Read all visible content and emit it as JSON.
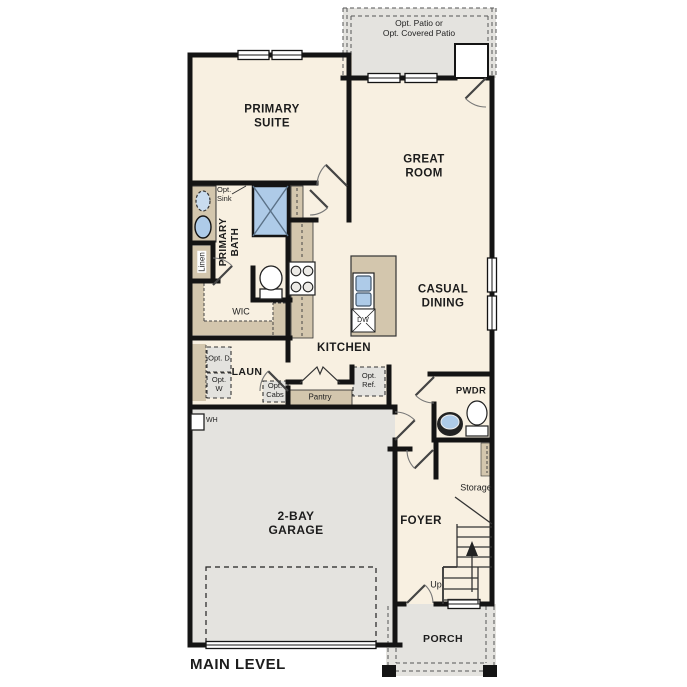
{
  "title": "MAIN LEVEL",
  "colors": {
    "floor": "#f8f0e1",
    "zone": "#e4e3df",
    "cabinet": "#d3c6ad",
    "fixture": "#aecbe8",
    "wall": "#141414",
    "optbox": "#e3e2de",
    "ink": "#1c1c1c"
  },
  "patio": {
    "line1": "Opt. Patio or",
    "line2": "Opt. Covered Patio"
  },
  "rooms": {
    "primary_suite": "PRIMARY SUITE",
    "great_room": "GREAT ROOM",
    "casual_dining": "CASUAL DINING",
    "kitchen": "KITCHEN",
    "primary_bath": "PRIMARY BATH",
    "wic": "WIC",
    "laundry": "LAUN",
    "pwdr": "PWDR",
    "foyer": "FOYER",
    "garage": "2-BAY GARAGE",
    "porch": "PORCH",
    "storage": "Storage"
  },
  "features": {
    "opt_sink": "Opt. Sink",
    "linen": "Linen",
    "opt_d": "Opt. D",
    "opt_w": "Opt. W",
    "opt_cabs": "Opt. Cabs",
    "pantry": "Pantry",
    "opt_ref": "Opt. Ref.",
    "dw": "DW",
    "wh": "WH",
    "up": "Up"
  }
}
